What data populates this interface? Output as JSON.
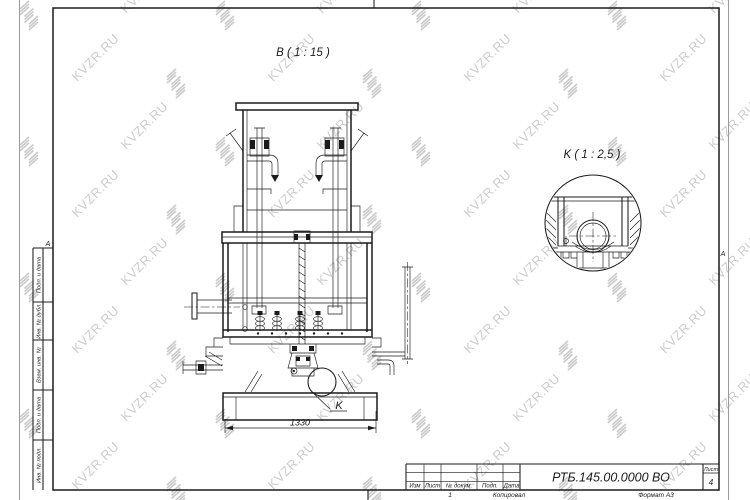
{
  "watermark": {
    "text": "KVZR.RU"
  },
  "sheet": {
    "zone_marker_left": "A",
    "zone_marker_right": "A",
    "margin_labels": [
      "Подп. и дата",
      "Инв. № дубл.",
      "Взам. инв. №",
      "Подп. и дата",
      "Инв. № подл."
    ]
  },
  "drawing": {
    "view_label": "B ( 1 : 15 )",
    "detail_label": "K ( 1 : 2,5 )",
    "detail_callout": "K",
    "dimension": "1330"
  },
  "title_block": {
    "doc_number": "РТБ.145.00.0000 ВО",
    "columns": [
      "Изм",
      "Лист",
      "№ докум.",
      "Подп.",
      "Дата"
    ],
    "sheet_label": "Лист",
    "sheet_number": "4",
    "footer_page": "1",
    "footer_copy": "Копировал",
    "footer_format": "Формат А3"
  }
}
